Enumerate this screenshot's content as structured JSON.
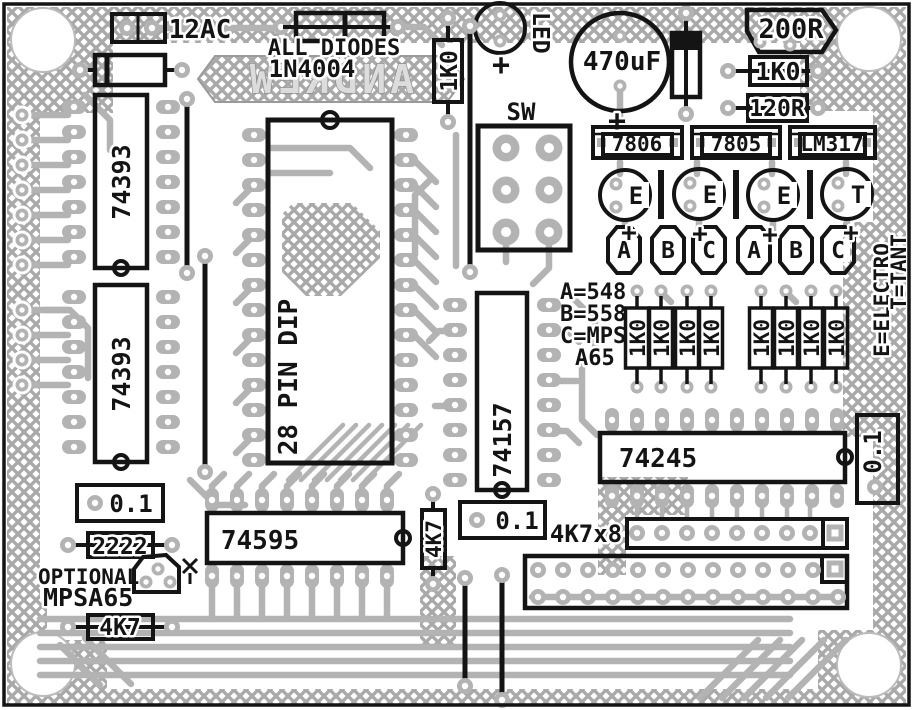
{
  "board": {
    "type": "pcb-component-layout",
    "watermark": "ANDREW",
    "colors": {
      "silkscreen": "#141414",
      "copper": "#b3b3b3",
      "board": "#ffffff",
      "pour_hatch": "#a9a9a9"
    }
  },
  "labels": {
    "ac": "12AC",
    "diodes_note_1": "ALL DIODES",
    "diodes_note_2": "1N4004",
    "r1k0_vert": "1K0",
    "led": "LED",
    "plus": "+",
    "cap470": "470uF",
    "r200": "200R",
    "r1k0_h": "1K0",
    "r120": "120R",
    "sw": "SW",
    "legend_a": "A=548",
    "legend_b": "B=558",
    "legend_c": "C=MPS",
    "legend_c2": "A65",
    "legend_e": "E=ELECTRO",
    "legend_t": "T=TANT",
    "ic1": "74393",
    "ic2": "74393",
    "dip": "28 PIN DIP",
    "mux": "74157",
    "shift": "74595",
    "buf": "74245",
    "cap01_a": "0.1",
    "cap01_b": "0.1",
    "cap01_c": "0.1",
    "r2222": "2222",
    "optional_1": "OPTIONAL",
    "optional_2": "MPSA65",
    "r4k7_a": "4K7",
    "r4k7_b": "4K7",
    "sil": "4K7x8"
  },
  "regulators": [
    "7806",
    "7805",
    "LM317"
  ],
  "cap_codes": [
    "E",
    "E",
    "E",
    "T"
  ],
  "transistor_codes": [
    "A",
    "B",
    "C",
    "A",
    "B",
    "C"
  ],
  "resistor_bank_left": [
    "1K0",
    "1K0",
    "1K0",
    "1K0"
  ],
  "resistor_bank_right": [
    "1K0",
    "1K0",
    "1K0",
    "1K0"
  ]
}
